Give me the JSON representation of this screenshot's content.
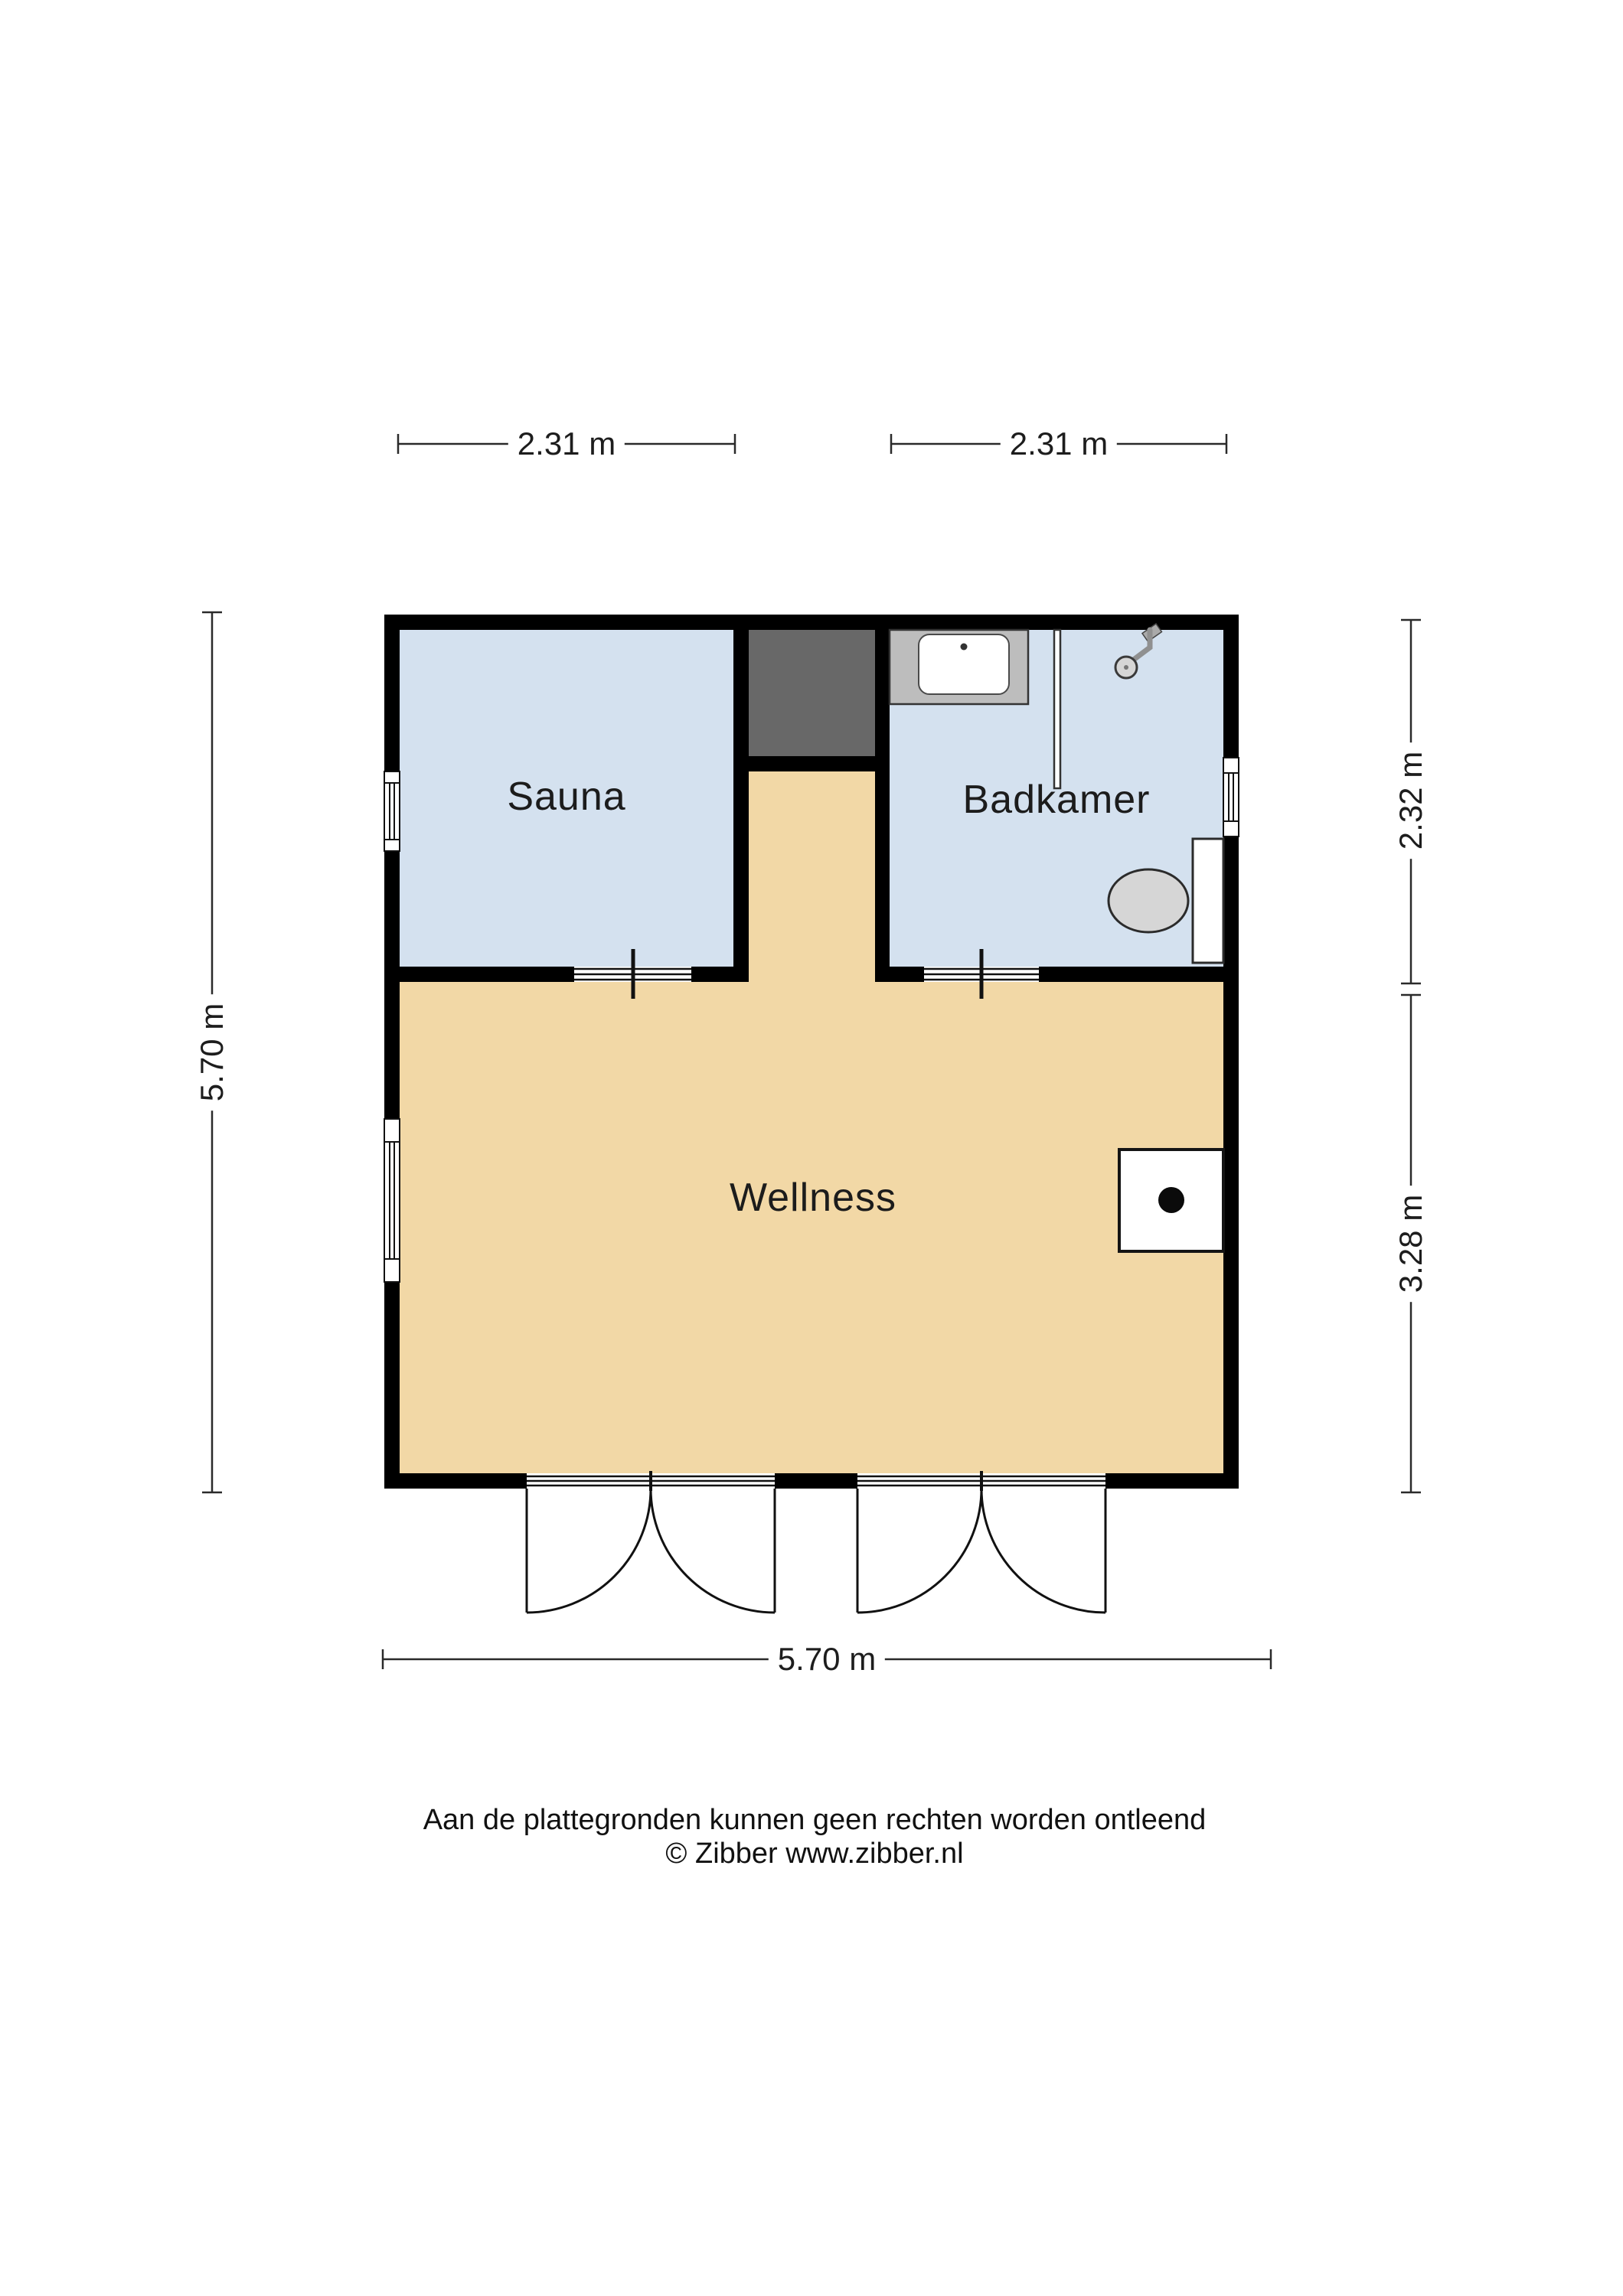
{
  "document": {
    "type": "floor-plan",
    "level_name": "Wellness"
  },
  "rooms": [
    {
      "label": "Sauna"
    },
    {
      "label": "Badkamer"
    },
    {
      "label": "Wellness"
    }
  ],
  "dimensions": {
    "top_left": "2.31 m",
    "top_right": "2.31 m",
    "left": "5.70 m",
    "right_upper": "2.32 m",
    "right_lower": "3.28 m",
    "bottom": "5.70 m"
  },
  "footer": {
    "line1": "Aan de plattegronden kunnen geen rechten worden ontleend",
    "line2": "© Zibber www.zibber.nl"
  },
  "colors": {
    "background": "#ffffff",
    "wall": "#000000",
    "wet_room_fill": "#d4e1ef",
    "living_fill": "#f2d8a6",
    "heater_block": "#686868",
    "counter_gray": "#bdbdbd",
    "fixture_gray": "#d6d6d6",
    "line_dark": "#1f1f1f"
  },
  "icons": {
    "window": "window-icon",
    "sliding_door": "sliding-door-icon",
    "double_swing_door": "double-swing-door-icon",
    "shower_tray": "shower-tray-icon",
    "shower_screen": "shower-screen-icon",
    "shower_head": "shower-head-icon",
    "toilet": "toilet-icon",
    "stove": "stove-icon"
  }
}
